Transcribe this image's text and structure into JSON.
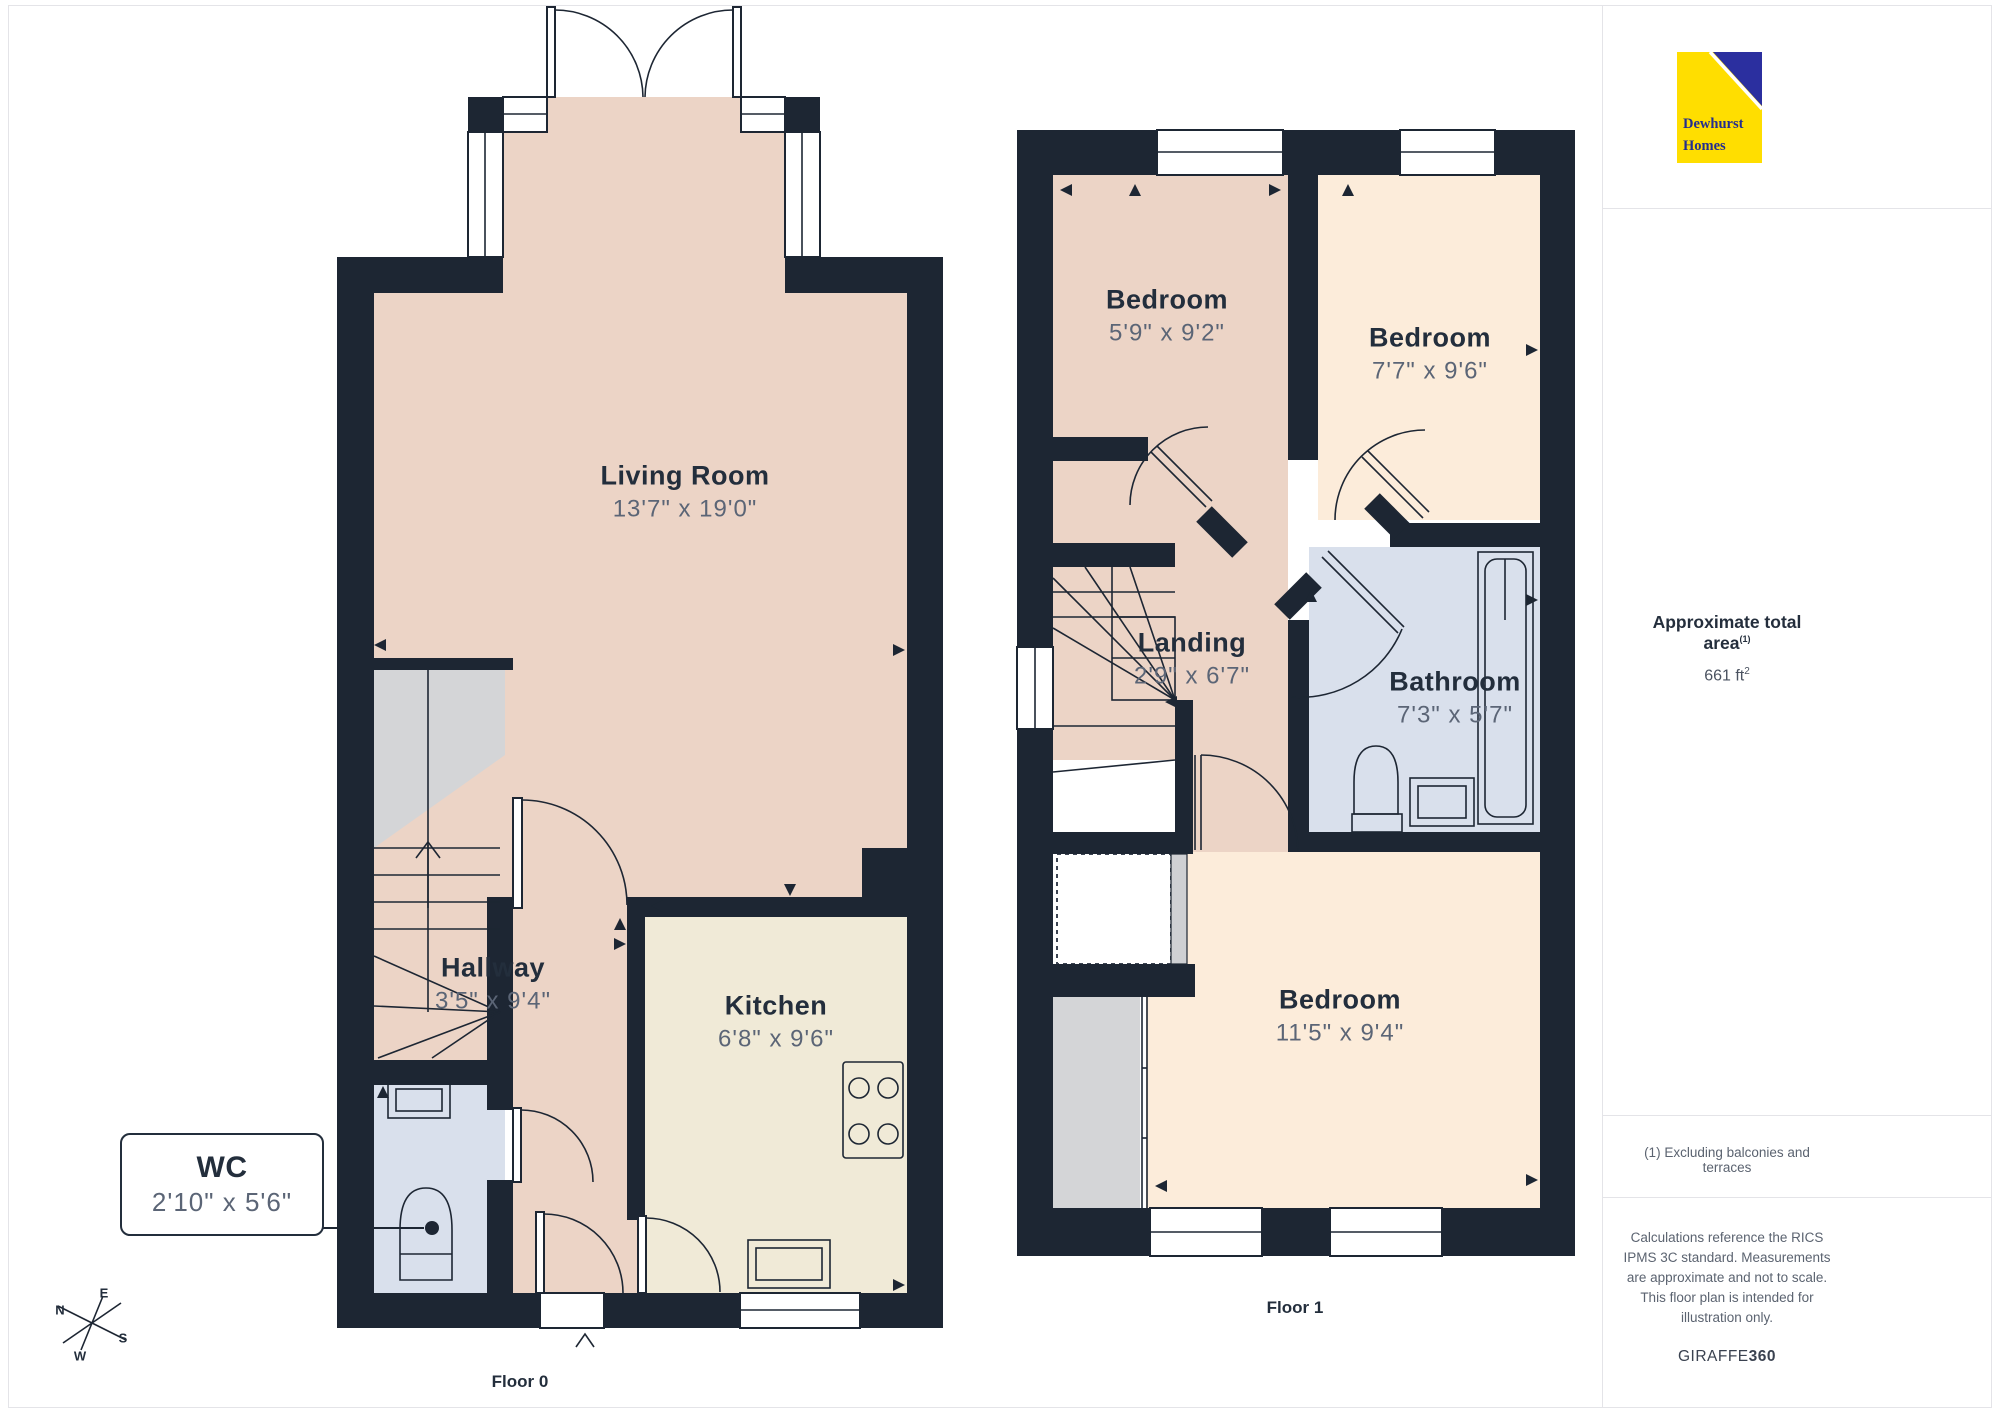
{
  "colors": {
    "wall": "#1d2633",
    "pink": "#ecd4c6",
    "cream": "#f0ead7",
    "peach": "#fcecda",
    "blue": "#d9e0ec",
    "gray": "#d4d5d7",
    "logo_yellow": "#ffde00",
    "logo_blue": "#2b2f9f",
    "title_text": "#232e3c",
    "dims_text": "#5b6576"
  },
  "logo": {
    "line1": "Dewhurst",
    "line2": "Homes"
  },
  "sidebar": {
    "area_title": "Approximate total area",
    "area_footnote_marker": "(1)",
    "area_value": "661 ft",
    "area_value_exponent": "2",
    "footnote": "(1) Excluding balconies and terraces",
    "disclaimer": "Calculations reference the RICS IPMS 3C standard. Measurements are approximate and not to scale. This floor plan is intended for illustration only.",
    "brand_name": "GIRAFFE",
    "brand_suffix": "360"
  },
  "floor0": {
    "label": "Floor 0",
    "rooms": {
      "living": {
        "name": "Living Room",
        "dims": "13'7\" x 19'0\""
      },
      "hallway": {
        "name": "Hallway",
        "dims": "3'5\" x 9'4\""
      },
      "kitchen": {
        "name": "Kitchen",
        "dims": "6'8\" x 9'6\""
      },
      "wc": {
        "name": "WC",
        "dims": "2'10\" x 5'6\""
      }
    }
  },
  "floor1": {
    "label": "Floor 1",
    "rooms": {
      "bedroom_small": {
        "name": "Bedroom",
        "dims": "5'9\" x 9'2\""
      },
      "bedroom_mid": {
        "name": "Bedroom",
        "dims": "7'7\" x 9'6\""
      },
      "landing": {
        "name": "Landing",
        "dims": "2'9\" x 6'7\""
      },
      "bathroom": {
        "name": "Bathroom",
        "dims": "7'3\" x 5'7\""
      },
      "bedroom_large": {
        "name": "Bedroom",
        "dims": "11'5\" x 9'4\""
      }
    }
  },
  "compass": {
    "n": "N",
    "e": "E",
    "s": "S",
    "w": "W"
  }
}
